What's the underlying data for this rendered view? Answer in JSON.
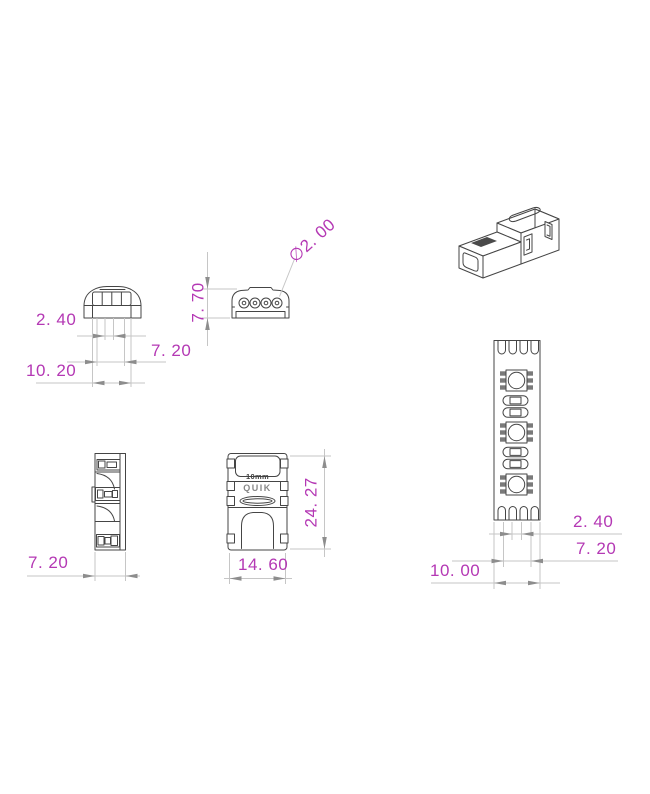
{
  "colors": {
    "magenta": "#b438b4",
    "outline": "#454545",
    "dimline": "#c6c6c6",
    "arrow": "#8d8d8d",
    "background": "#ffffff"
  },
  "views": {
    "end_cap": {
      "dim_inner": "2. 40",
      "dim_mid": "7. 20",
      "dim_outer": "10. 20"
    },
    "end_holes": {
      "dim_height": "7. 70",
      "dim_hole_dia": "∅2. 00"
    },
    "side": {
      "dim_width": "7. 20"
    },
    "top": {
      "dim_length": "24. 27",
      "dim_width": "14. 60",
      "label_size": "10mm",
      "label_brand": "QUIK"
    },
    "strip": {
      "dim_pad": "2. 40",
      "dim_inner": "7. 20",
      "dim_width": "10. 00"
    }
  }
}
